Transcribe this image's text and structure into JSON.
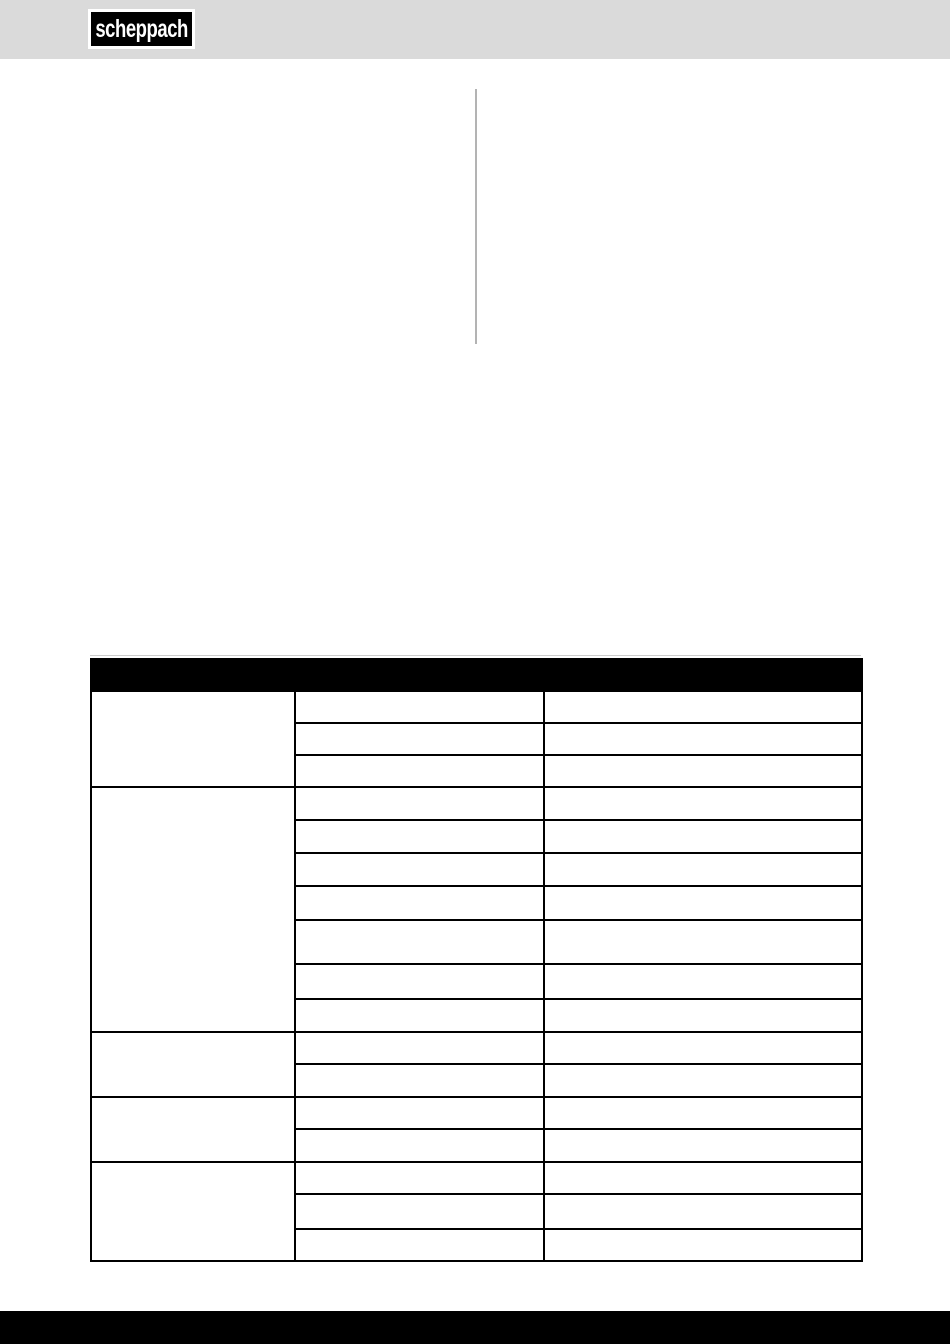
{
  "page": {
    "width": 950,
    "height": 1344,
    "background": "#ffffff"
  },
  "header_band": {
    "background": "#dadada",
    "logo": {
      "text": "scheppach",
      "frame_color": "#ffffff",
      "box_color": "#000000",
      "text_color": "#ffffff"
    }
  },
  "content_divider": {
    "color": "#b3b3b3"
  },
  "troubleshooting_table": {
    "top_line_color": "#cccccc",
    "border_color": "#000000",
    "header": {
      "label": "",
      "background": "#000000",
      "text_color": "#ffffff",
      "height": 26
    },
    "columns": [
      {
        "name": "fault",
        "width": 204
      },
      {
        "name": "cause",
        "width": 249
      },
      {
        "name": "remedy",
        "width": 318
      }
    ],
    "groups": [
      {
        "fault": "",
        "rows": [
          {
            "height": 26,
            "cause": "",
            "remedy": ""
          },
          {
            "height": 26,
            "cause": "",
            "remedy": ""
          },
          {
            "height": 26,
            "cause": "",
            "remedy": ""
          }
        ]
      },
      {
        "fault": "",
        "rows": [
          {
            "height": 27,
            "cause": "",
            "remedy": ""
          },
          {
            "height": 27,
            "cause": "",
            "remedy": ""
          },
          {
            "height": 27,
            "cause": "",
            "remedy": ""
          },
          {
            "height": 28,
            "cause": "",
            "remedy": ""
          },
          {
            "height": 38,
            "cause": "",
            "remedy": ""
          },
          {
            "height": 29,
            "cause": "",
            "remedy": ""
          },
          {
            "height": 27,
            "cause": "",
            "remedy": ""
          }
        ]
      },
      {
        "fault": "",
        "rows": [
          {
            "height": 26,
            "cause": "",
            "remedy": ""
          },
          {
            "height": 27,
            "cause": "",
            "remedy": ""
          }
        ]
      },
      {
        "fault": "",
        "rows": [
          {
            "height": 26,
            "cause": "",
            "remedy": ""
          },
          {
            "height": 27,
            "cause": "",
            "remedy": ""
          }
        ]
      },
      {
        "fault": "",
        "rows": [
          {
            "height": 26,
            "cause": "",
            "remedy": ""
          },
          {
            "height": 29,
            "cause": "",
            "remedy": ""
          },
          {
            "height": 26,
            "cause": "",
            "remedy": ""
          }
        ]
      }
    ]
  },
  "footer_bar": {
    "background": "#000000",
    "height": 33
  }
}
